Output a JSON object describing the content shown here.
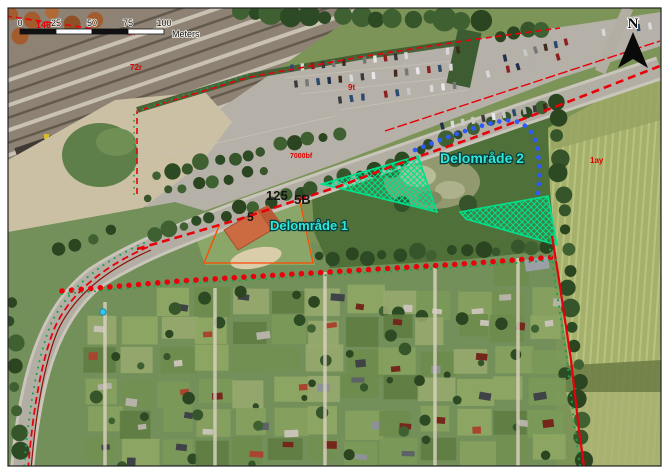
{
  "compass": {
    "north_label": "N"
  },
  "scale_bar": {
    "tick_labels": [
      "0",
      "25",
      "50",
      "75",
      "100"
    ],
    "unit_label": "Meters"
  },
  "area_labels": {
    "delomraade_1": "Delområde 1",
    "delomraade_2": "Delområde 2"
  },
  "cadastral_labels": {
    "under_scalebar": "146",
    "railway": "72r",
    "parking": "9t",
    "road": "7000bf",
    "east_field": "1ay",
    "house_number_125": "125",
    "house_number_5b": "5B",
    "house_number_5": "5"
  },
  "colors": {
    "plan_boundary_red": "#e8000a",
    "dark_boundary_red": "#8a1208",
    "subarea_line_orange": "#ff4a00",
    "blue_dotted_line": "#2e5bff",
    "green_dotted_line": "#18a34a",
    "hatch_green": "#00e08c",
    "area_label_cyan": "#2fe8d8",
    "area_label_halo": "#083a3a",
    "cadastral_red": "#e00000",
    "black_text": "#141414"
  }
}
